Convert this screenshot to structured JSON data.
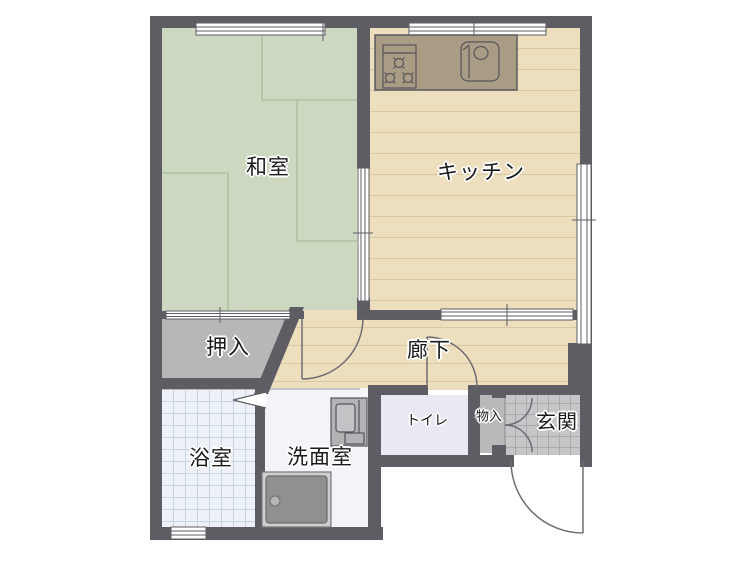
{
  "floorplan": {
    "type": "japanese-apartment-floor-plan",
    "rooms": {
      "washitsu": {
        "label": "和室"
      },
      "kitchen": {
        "label": "キッチン"
      },
      "oshiire": {
        "label": "押入"
      },
      "rouka": {
        "label": "廊下"
      },
      "yokushitsu": {
        "label": "浴室"
      },
      "senmen": {
        "label": "洗面室"
      },
      "toilet": {
        "label": "トイレ"
      },
      "monoire": {
        "label": "物入"
      },
      "genkan": {
        "label": "玄関"
      }
    },
    "fixtures": [
      "stove-burners-icon",
      "kitchen-sink-icon",
      "vanity-sink-icon",
      "washer-pan-icon"
    ],
    "symbols": [
      "window-symbol",
      "sliding-door-symbol",
      "swing-door-arc",
      "double-door-arcs",
      "folding-door-symbol"
    ],
    "colors": {
      "wall": "#5d5d63",
      "tatami": "#cdd8c1",
      "tatami_line": "#a9ba9b",
      "wood_floor": "#eddfbe",
      "wood_line": "#d9c8a5",
      "closet": "#b7b7b8",
      "bath_tile": "#eef1f8",
      "bath_grid": "#c7d4e4",
      "washroom": "#f3f3f8",
      "toilet_floor": "#e9e9f3",
      "storage": "#b9b9ba",
      "genkan_tile": "#c6c6c8",
      "counter": "#a99b84",
      "fixture_gray": "#919193",
      "door_arc": "#6d6d73"
    }
  }
}
